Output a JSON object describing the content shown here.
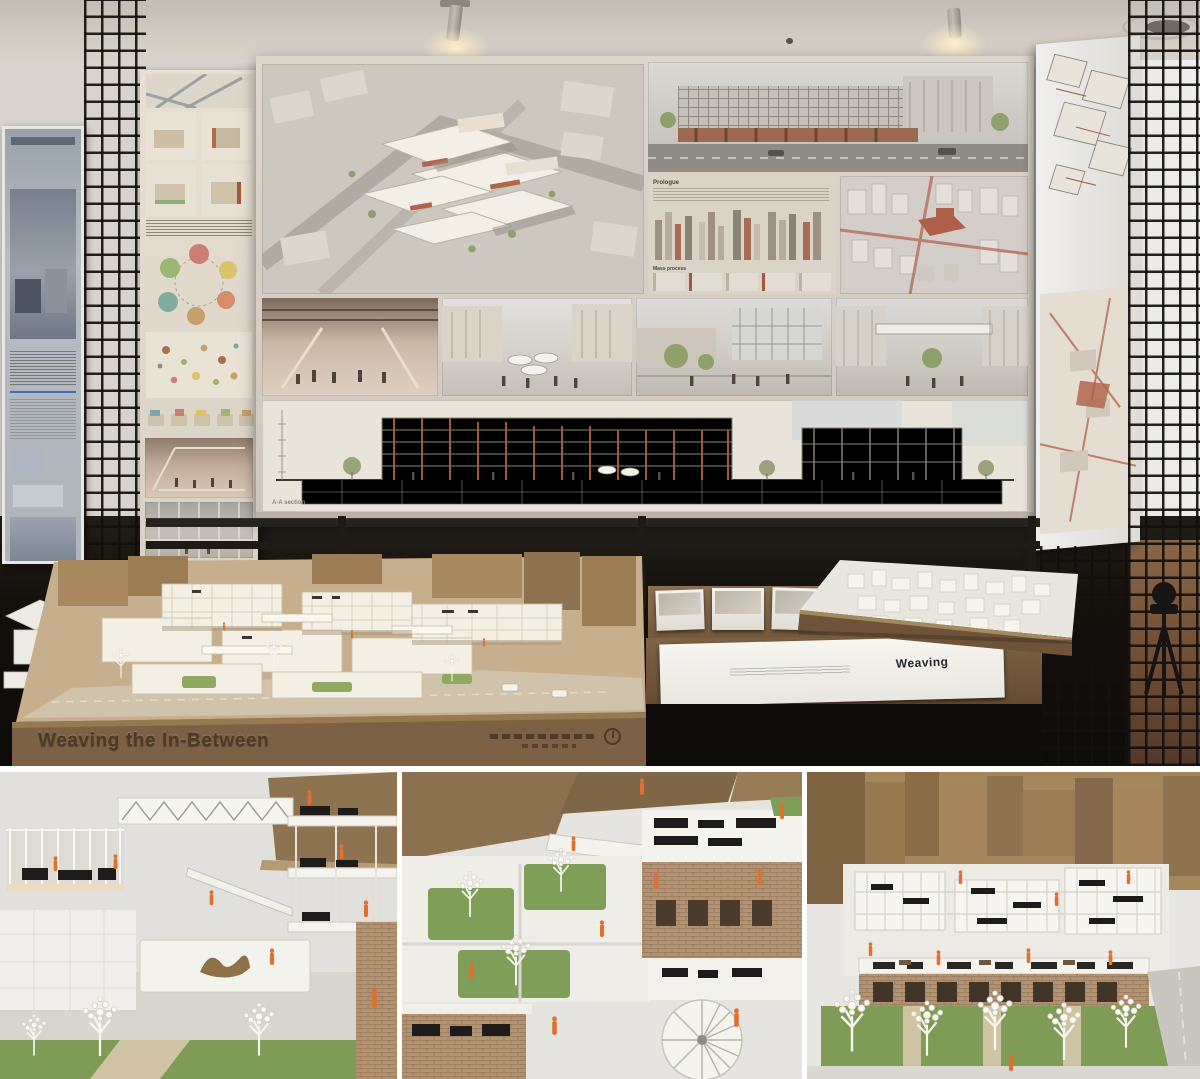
{
  "scene": {
    "board": {
      "title": "Weaving the In-Between",
      "prologue_label": "Prologue",
      "mass_process_label": "Mass process",
      "section_label": "A-A section"
    },
    "model": {
      "plaque_text": "Weaving the In-Between"
    },
    "table": {
      "booklet_cover_text": "Weaving"
    },
    "colors": {
      "accent_orange": "#e0702f",
      "wood_base": "#7c6144",
      "cardboard": "#9b7c55",
      "brick": "#b29270",
      "lawn_green": "#7e9c56",
      "title_brown": "#5d4136",
      "cloth_black": "#14110d"
    }
  }
}
